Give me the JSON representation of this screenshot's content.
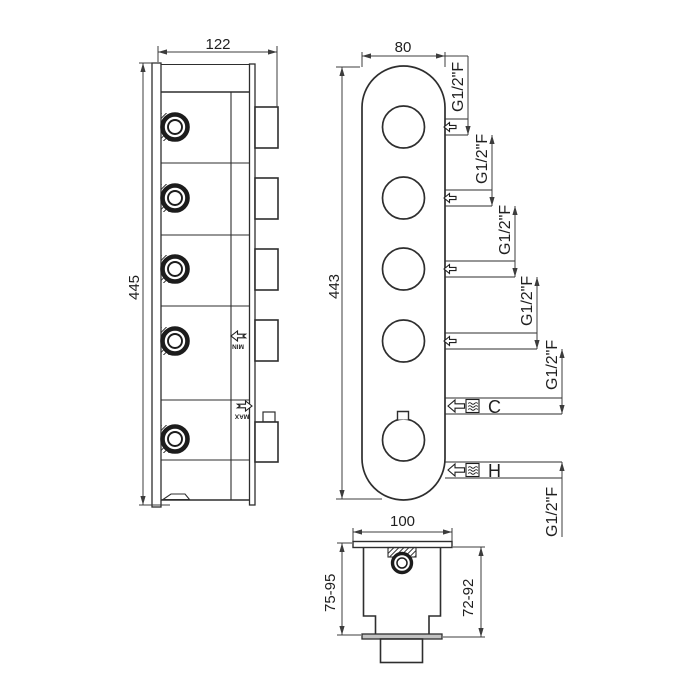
{
  "drawing": {
    "side_view": {
      "width_dim": "122",
      "height_dim": "445",
      "min_label": "MIN",
      "max_label": "MAX"
    },
    "front_view": {
      "width_dim": "80",
      "height_dim": "443",
      "cold_label": "C",
      "hot_label": "H",
      "thread_labels": [
        "G1/2\"F",
        "G1/2\"F",
        "G1/2\"F",
        "G1/2\"F",
        "G1/2\"F",
        "G1/2\"F"
      ]
    },
    "section_view": {
      "width_dim": "100",
      "depth_dim_left": "75-95",
      "depth_dim_right": "72-92"
    },
    "icons": {
      "port_arrow": "flow-arrow-left",
      "water": "wavy-water-symbol",
      "min_arrow": "notched-arrow-left",
      "max_arrow": "notched-arrow-right"
    },
    "colors": {
      "line": "#2e2e2e",
      "dim_line": "#3c3c3c",
      "plate_fill": "#c2c2c2"
    }
  }
}
